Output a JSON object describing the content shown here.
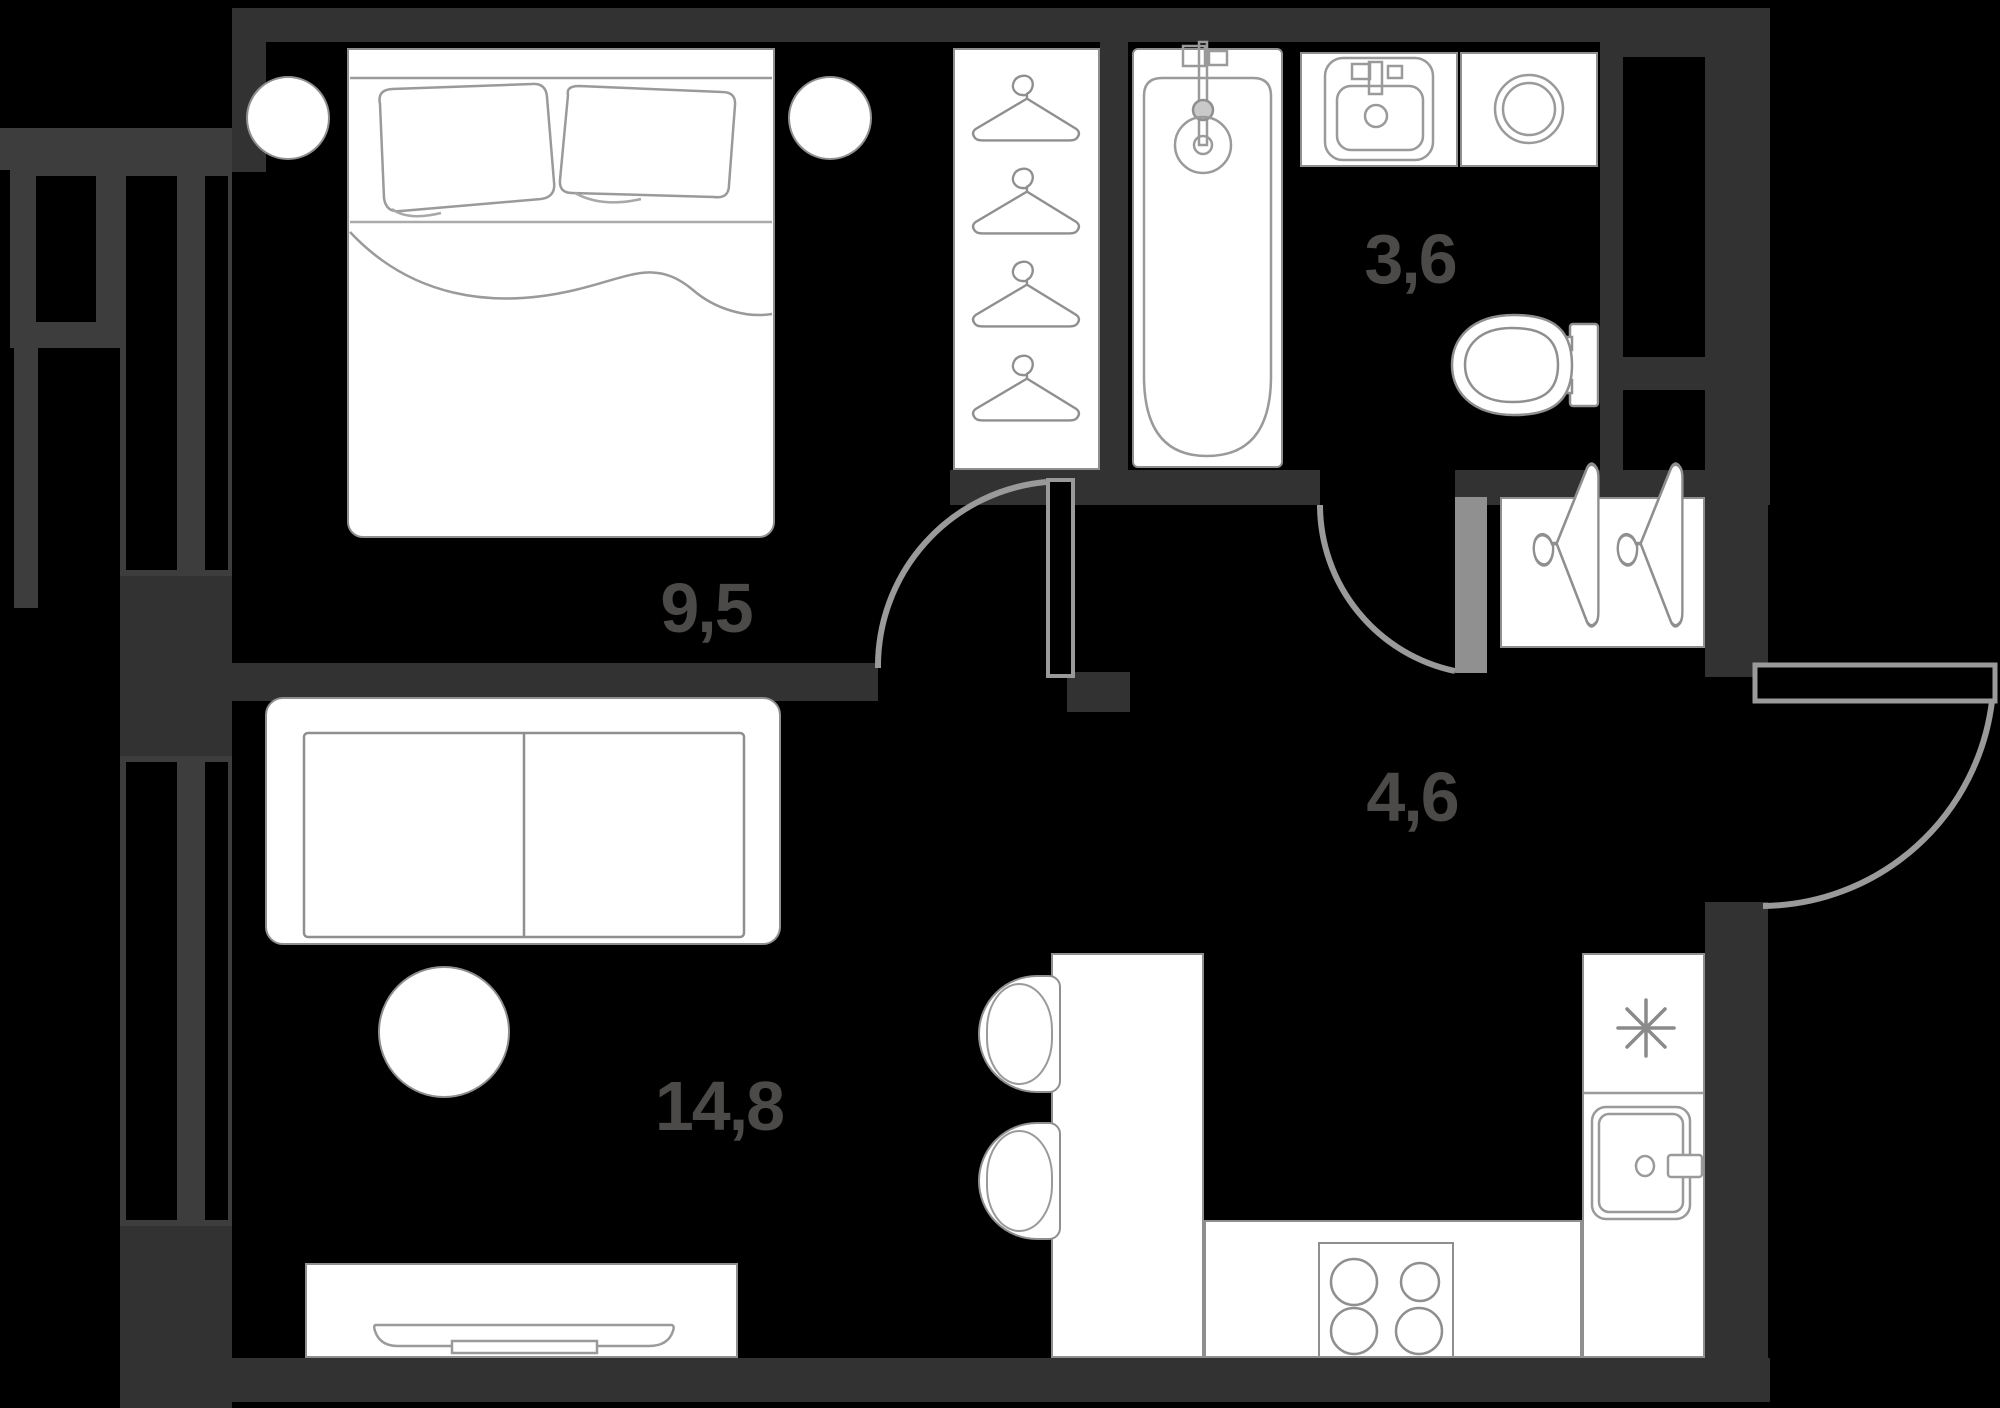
{
  "plan": {
    "title": "apartment-floor-plan",
    "rooms": {
      "bedroom": {
        "name": "bedroom",
        "area": "9,5"
      },
      "bathroom": {
        "name": "bathroom",
        "area": "3,6"
      },
      "hallway": {
        "name": "hallway",
        "area": "4,6"
      },
      "living_kitchen": {
        "name": "living-kitchen",
        "area": "14,8"
      }
    },
    "colors": {
      "background": "#000000",
      "wall": "#323232",
      "window_frame": "#3d3d3d",
      "line": "#9a9a9a",
      "furniture_outline": "#8f8f8f",
      "furniture_fill": "#ffffff",
      "label_text": "#4b4a48"
    },
    "furniture": [
      "double-bed",
      "nightstand-left",
      "nightstand-right",
      "wardrobe-with-hangers",
      "bathtub",
      "bathroom-sink",
      "washing-machine",
      "toilet",
      "hallway-closet",
      "sofa",
      "round-table",
      "tv-stand",
      "kitchen-counter",
      "stove",
      "refrigerator",
      "kitchen-sink",
      "chair",
      "chair"
    ],
    "counts": {
      "wardrobe_hangers": 4,
      "closet_hangers": 2,
      "stove_burners": 4,
      "doors": 3
    }
  }
}
